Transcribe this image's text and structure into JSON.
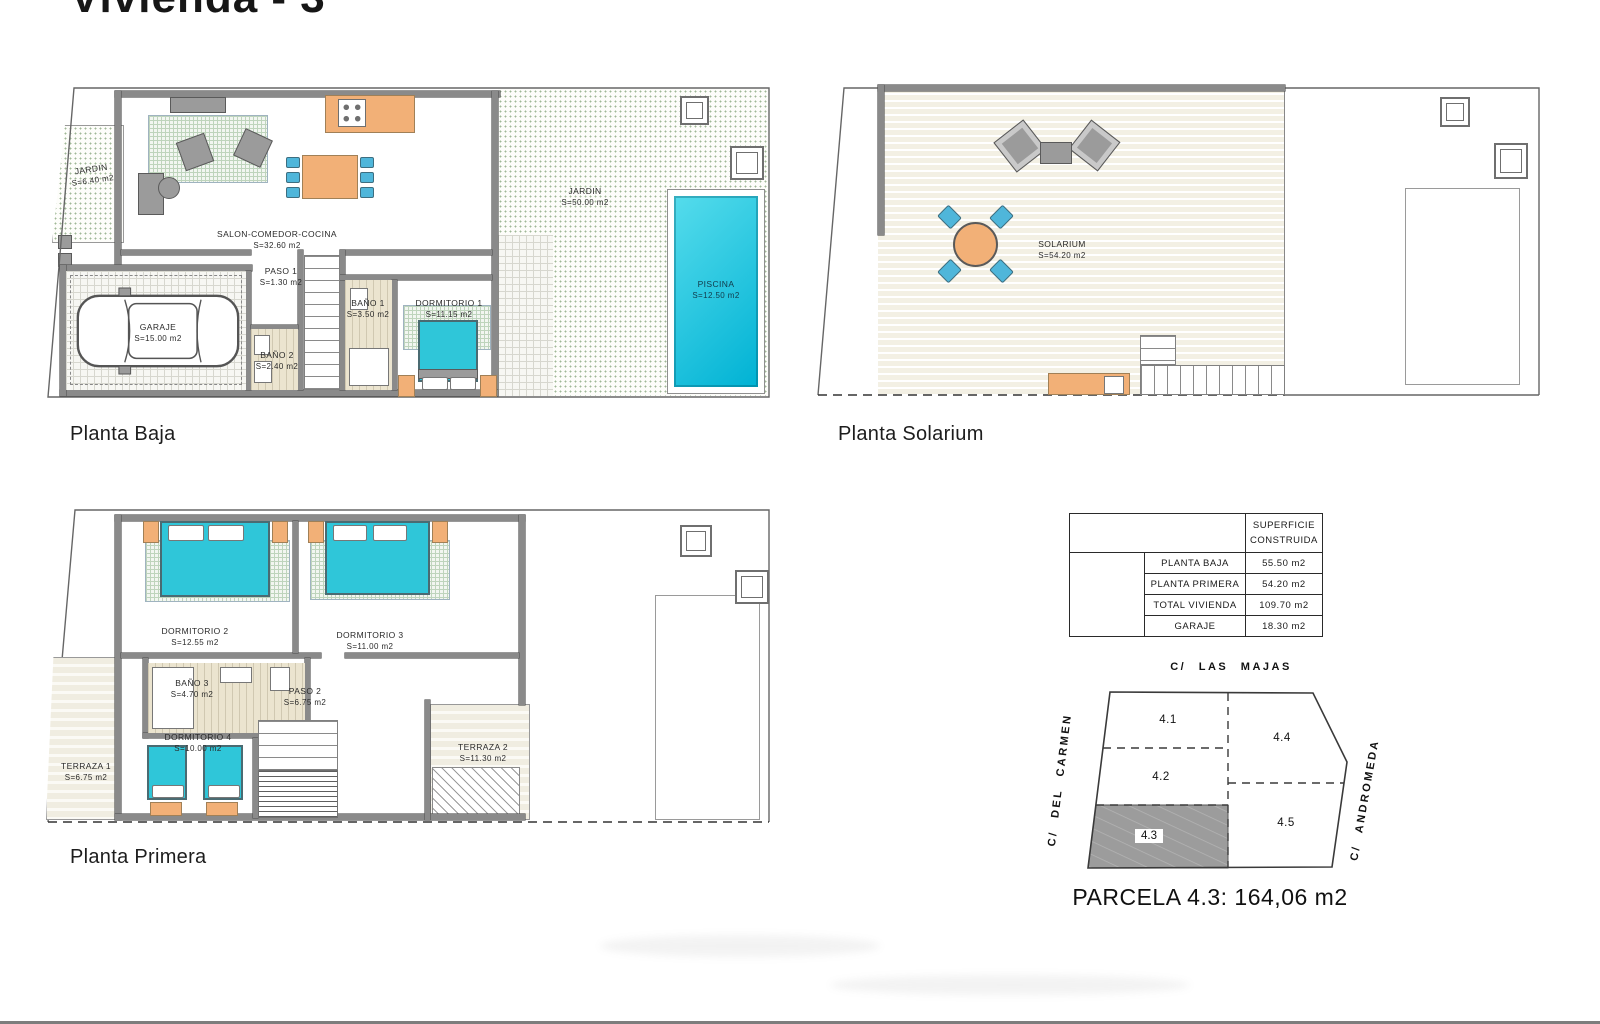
{
  "title": "Vivienda - 3",
  "captions": {
    "baja": "Planta Baja",
    "solarium": "Planta Solarium",
    "primera": "Planta Primera"
  },
  "rooms": {
    "baja": {
      "jardin_left": {
        "name": "JARDIN",
        "area": "S=6.40  m2"
      },
      "salon": {
        "name": "SALON-COMEDOR-COCINA",
        "area": "S=32.60  m2"
      },
      "paso1": {
        "name": "PASO  1",
        "area": "S=1.30  m2"
      },
      "garaje": {
        "name": "GARAJE",
        "area": "S=15.00  m2"
      },
      "bano2": {
        "name": "BAÑO  2",
        "area": "S=2.40  m2"
      },
      "bano1": {
        "name": "BAÑO  1",
        "area": "S=3.50  m2"
      },
      "dorm1": {
        "name": "DORMITORIO  1",
        "area": "S=11.15  m2"
      },
      "jardin": {
        "name": "JARDIN",
        "area": "S=50.00  m2"
      },
      "piscina": {
        "name": "PISCINA",
        "area": "S=12.50  m2"
      }
    },
    "solarium": {
      "solarium": {
        "name": "SOLARIUM",
        "area": "S=54.20  m2"
      }
    },
    "primera": {
      "dorm2": {
        "name": "DORMITORIO  2",
        "area": "S=12.55  m2"
      },
      "dorm3": {
        "name": "DORMITORIO  3",
        "area": "S=11.00  m2"
      },
      "bano3": {
        "name": "BAÑO  3",
        "area": "S=4.70  m2"
      },
      "paso2": {
        "name": "PASO  2",
        "area": "S=6.75  m2"
      },
      "dorm4": {
        "name": "DORMITORIO  4",
        "area": "S=10.00  m2"
      },
      "terraza1": {
        "name": "TERRAZA  1",
        "area": "S=6.75  m2"
      },
      "terraza2": {
        "name": "TERRAZA  2",
        "area": "S=11.30  m2"
      }
    }
  },
  "table": {
    "header_line1": "SUPERFICIE",
    "header_line2": "CONSTRUIDA",
    "rows": [
      {
        "label": "PLANTA  BAJA",
        "value": "55.50  m2"
      },
      {
        "label": "PLANTA  PRIMERA",
        "value": "54.20  m2"
      },
      {
        "label": "TOTAL  VIVIENDA",
        "value": "109.70  m2"
      },
      {
        "label": "GARAJE",
        "value": "18.30  m2"
      }
    ]
  },
  "parcel": {
    "street_top": "C/ LAS MAJAS",
    "street_left": "C/ DEL CARMEN",
    "street_right": "C/ ANDROMEDA",
    "p41": "4.1",
    "p42": "4.2",
    "p43": "4.3",
    "p44": "4.4",
    "p45": "4.5",
    "caption": "PARCELA 4.3: 164,06 m2"
  },
  "colors": {
    "water": "#00b2d4",
    "bed": "#2fc6d9",
    "furniture_orange": "#f2b077",
    "chair_blue": "#4fb6da",
    "wall": "#8a8a8a",
    "parcel_fill": "#9c9c9c"
  }
}
